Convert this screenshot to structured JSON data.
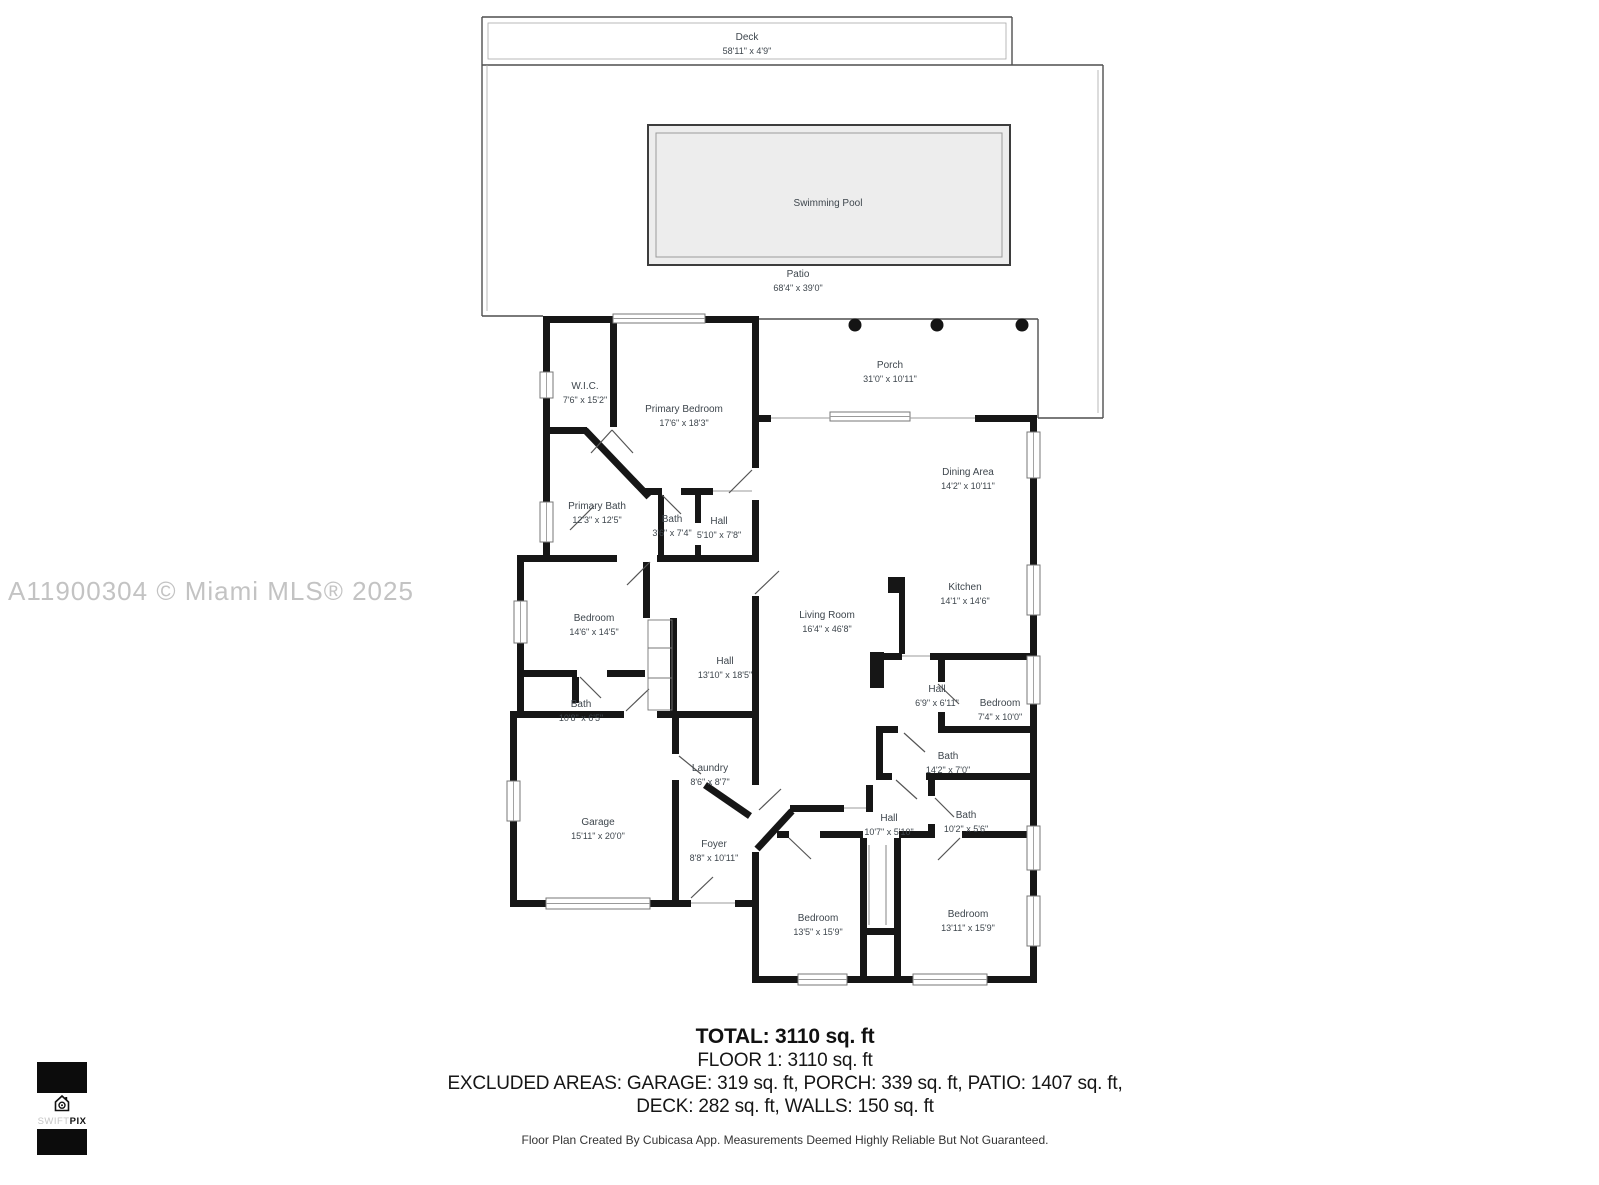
{
  "watermark": "A11900304 © Miami MLS® 2025",
  "logo": {
    "brand_light": "SWIFT",
    "brand_bold": "PIX"
  },
  "colors": {
    "wall": "#161616",
    "outdoor_outline": "#4f4f4f",
    "pool_fill": "#ededed",
    "label_text": "#3e464d",
    "watermark_text": "#c3c3c3"
  },
  "rooms": [
    {
      "id": "deck",
      "name": "Deck",
      "dims": "58'11\" x 4'9\""
    },
    {
      "id": "swimming-pool",
      "name": "Swimming Pool",
      "dims": ""
    },
    {
      "id": "patio",
      "name": "Patio",
      "dims": "68'4\" x 39'0\""
    },
    {
      "id": "porch",
      "name": "Porch",
      "dims": "31'0\" x 10'11\""
    },
    {
      "id": "wic",
      "name": "W.I.C.",
      "dims": "7'6\" x 15'2\""
    },
    {
      "id": "primary-bedroom",
      "name": "Primary Bedroom",
      "dims": "17'6\" x 18'3\""
    },
    {
      "id": "primary-bath",
      "name": "Primary Bath",
      "dims": "12'3\" x 12'5\""
    },
    {
      "id": "bath-3-6",
      "name": "Bath",
      "dims": "3'6\" x 7'4\""
    },
    {
      "id": "hall-5-10",
      "name": "Hall",
      "dims": "5'10\" x 7'8\""
    },
    {
      "id": "bedroom-14-6",
      "name": "Bedroom",
      "dims": "14'6\" x 14'5\""
    },
    {
      "id": "hall-13-10",
      "name": "Hall",
      "dims": "13'10\" x 18'5\""
    },
    {
      "id": "bath-10-8",
      "name": "Bath",
      "dims": "10'8\" x 6'5\""
    },
    {
      "id": "garage",
      "name": "Garage",
      "dims": "15'11\" x 20'0\""
    },
    {
      "id": "laundry",
      "name": "Laundry",
      "dims": "8'6\" x 8'7\""
    },
    {
      "id": "foyer",
      "name": "Foyer",
      "dims": "8'8\" x 10'11\""
    },
    {
      "id": "living-room",
      "name": "Living Room",
      "dims": "16'4\" x 46'8\""
    },
    {
      "id": "dining-area",
      "name": "Dining Area",
      "dims": "14'2\" x 10'11\""
    },
    {
      "id": "kitchen",
      "name": "Kitchen",
      "dims": "14'1\" x 14'6\""
    },
    {
      "id": "hall-6-9",
      "name": "Hall",
      "dims": "6'9\" x 6'11\""
    },
    {
      "id": "bedroom-7-4",
      "name": "Bedroom",
      "dims": "7'4\" x 10'0\""
    },
    {
      "id": "bath-14-2",
      "name": "Bath",
      "dims": "14'2\" x 7'0\""
    },
    {
      "id": "bath-10-2",
      "name": "Bath",
      "dims": "10'2\" x 5'6\""
    },
    {
      "id": "hall-10-7",
      "name": "Hall",
      "dims": "10'7\" x 5'10\""
    },
    {
      "id": "bedroom-13-5",
      "name": "Bedroom",
      "dims": "13'5\" x 15'9\""
    },
    {
      "id": "bedroom-13-11",
      "name": "Bedroom",
      "dims": "13'11\" x 15'9\""
    }
  ],
  "summary": {
    "total": "TOTAL: 3110 sq. ft",
    "floor1": "FLOOR 1: 3110 sq. ft",
    "excluded_line1": "EXCLUDED AREAS: GARAGE: 319 sq. ft, PORCH: 339 sq. ft, PATIO: 1407 sq. ft,",
    "excluded_line2": "DECK: 282 sq. ft, WALLS: 150 sq. ft",
    "disclaimer": "Floor Plan Created By Cubicasa App. Measurements Deemed Highly Reliable But Not Guaranteed."
  }
}
